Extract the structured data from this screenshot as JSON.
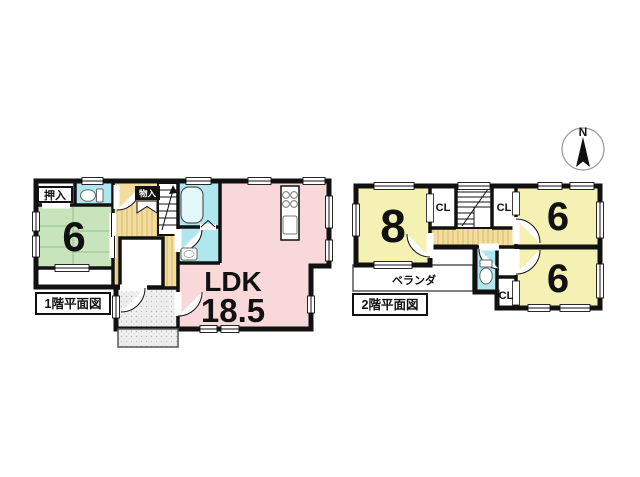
{
  "page": {
    "background": "#ffffff"
  },
  "compass": {
    "north_label": "N"
  },
  "floor1": {
    "caption": "1階平面図",
    "labels": {
      "oshiire": "押入",
      "monoire": "物入",
      "tatami_size": "6",
      "ldk_name": "LDK",
      "ldk_size": "18.5"
    }
  },
  "floor2": {
    "caption": "2階平面図",
    "labels": {
      "room8_size": "8",
      "room6_top_size": "6",
      "room6_bottom_size": "6",
      "cl_left": "CL",
      "cl_right": "CL",
      "cl_bottom": "CL",
      "veranda": "ベランダ"
    }
  },
  "colors": {
    "wall": "#111111",
    "tatami_green": "#c8e4bc",
    "ldk_pink": "#f8d8d8",
    "room_yellow": "#f5f1b3",
    "wet_cyan": "#b0e6ee",
    "floor_beige": "#f2dc9e",
    "background": "#ffffff"
  }
}
